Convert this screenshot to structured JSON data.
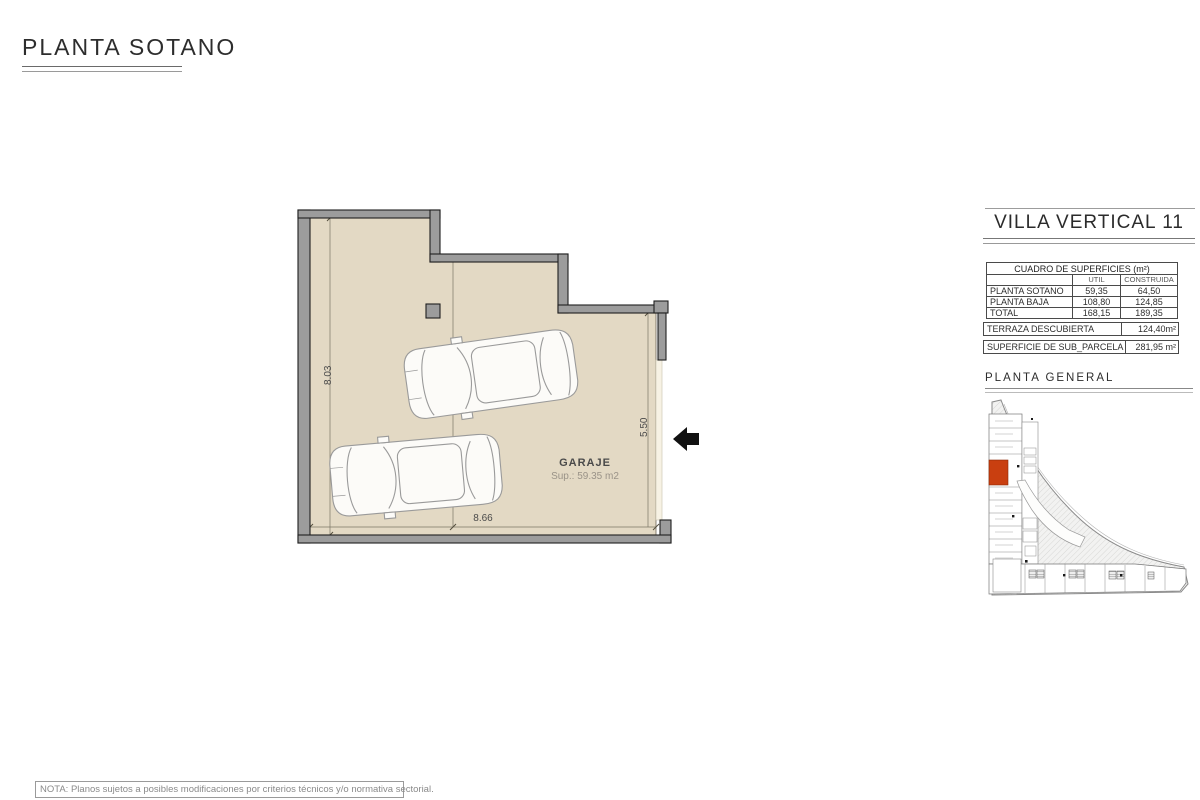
{
  "page": {
    "title": "PLANTA SOTANO",
    "note": "NOTA: Planos sujetos a posibles modificaciones por criterios técnicos y/o normativa sectorial."
  },
  "plan": {
    "room_label": "GARAJE",
    "room_area": "Sup.: 59.35  m2",
    "dim_left": "8.03",
    "dim_middle": "5.05",
    "dim_right": "5.50",
    "dim_bottom": "8.66"
  },
  "panel": {
    "title": "VILLA VERTICAL 11",
    "table": {
      "title": "CUADRO DE SUPERFICIES (m²)",
      "col_headers": {
        "util": "UTIL",
        "construida": "CONSTRUIDA"
      },
      "rows": [
        {
          "label": "PLANTA SOTANO",
          "util": "59,35",
          "construida": "64,50"
        },
        {
          "label": "PLANTA BAJA",
          "util": "108,80",
          "construida": "124,85"
        },
        {
          "label": "TOTAL",
          "util": "168,15",
          "construida": "189,35"
        }
      ]
    },
    "terraza": {
      "label": "TERRAZA DESCUBIERTA",
      "value": "124,40m²"
    },
    "subparcela": {
      "label": "SUPERFICIE DE SUB_PARCELA  11",
      "value": "281,95 m²"
    },
    "site_plan_title": "PLANTA  GENERAL"
  },
  "colors": {
    "floor": "#e3d9c4",
    "wall": "#9c9c9c",
    "highlight_unit": "#c93f10",
    "dimension_line": "#7a7466",
    "arrow": "#111111"
  }
}
